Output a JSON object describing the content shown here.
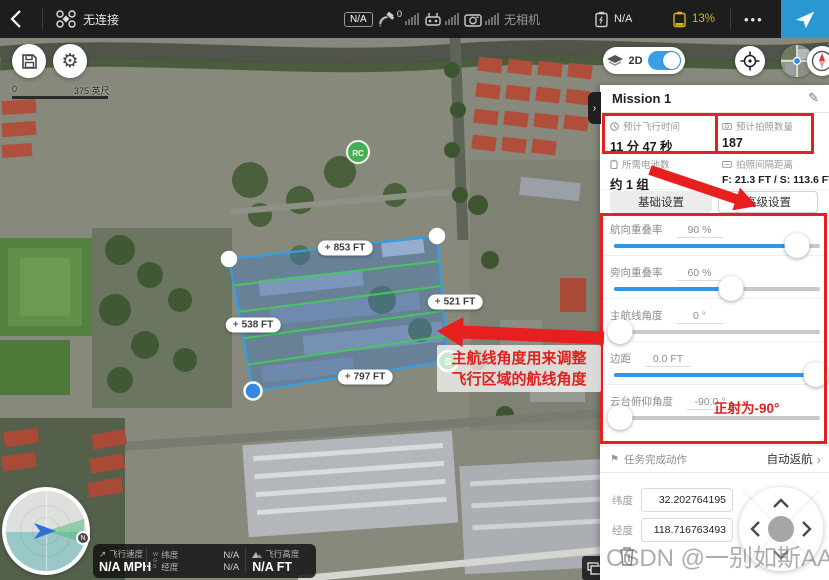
{
  "top_bar": {
    "connection_status": "无连接",
    "gps_badge": "N/A",
    "satellite_count": "0",
    "camera_status": "无相机",
    "rc_status": "N/A",
    "battery_percent": "13%",
    "more_label": "•••"
  },
  "map": {
    "scale_zero": "0",
    "scale_label": "375 英尺",
    "mode_label": "2D",
    "polygon_labels": {
      "top": "853 FT",
      "right": "521 FT",
      "left": "538 FT",
      "bottom": "797 FT"
    },
    "start_marker": "S",
    "rc_marker": "RC",
    "compass_north": "N"
  },
  "annotations": {
    "route_angle_note_line1": "主航线角度用来调整",
    "route_angle_note_line2": "飞行区域的航线角度",
    "gimbal_note": "正射为-90°"
  },
  "panel": {
    "title": "Mission 1",
    "stats": [
      {
        "label": "预计飞行时间",
        "value": "11 分 47 秒"
      },
      {
        "label": "预计拍照数量",
        "value": "187"
      },
      {
        "label": "所需电池数",
        "value": "约 1 组"
      },
      {
        "label": "拍照间隔距离",
        "value": "F: 21.3 FT / S: 113.6 FT"
      }
    ],
    "tabs": [
      {
        "label": "基础设置",
        "active": false
      },
      {
        "label": "高级设置",
        "active": true
      }
    ],
    "sliders": [
      {
        "label": "航向重叠率",
        "value": "90 %",
        "percent": 89,
        "filled": true
      },
      {
        "label": "旁向重叠率",
        "value": "60 %",
        "percent": 57,
        "filled": true
      },
      {
        "label": "主航线角度",
        "value": "0 °",
        "percent": 3,
        "filled": false
      },
      {
        "label": "边距",
        "value": "0.0 FT",
        "percent": 98,
        "filled": true
      },
      {
        "label": "云台俯仰角度",
        "value": "-90.0 °",
        "percent": 3,
        "filled": false
      }
    ],
    "finish_action": {
      "label": "任务完成动作",
      "value": "自动返航"
    },
    "coords": [
      {
        "label": "纬度",
        "value": "32.202764195"
      },
      {
        "label": "经度",
        "value": "118.716763493"
      }
    ]
  },
  "telemetry": {
    "speed_label": "飞行速度",
    "speed_value": "N/A MPH",
    "wgs_letters": [
      "W",
      "G",
      "S"
    ],
    "lat_label": "纬度",
    "lat_value": "N/A",
    "lng_label": "经度",
    "lng_value": "N/A",
    "alt_label": "飞行高度",
    "alt_value": "N/A FT"
  },
  "watermark": "CSDN @一别如斯AA",
  "icons": {
    "gear": "⚙",
    "pencil": "✎",
    "arrow_ne": "↗",
    "plus": "+",
    "chevron_right": "›",
    "flag": "⚑"
  },
  "colors": {
    "accent_blue": "#2a97d3",
    "slider_blue": "#2f96e8",
    "annotation_red": "#e81f1f",
    "battery_yellow": "#d9b022",
    "route_green": "#3fcf54",
    "polygon_stroke": "#2ea1ec"
  }
}
